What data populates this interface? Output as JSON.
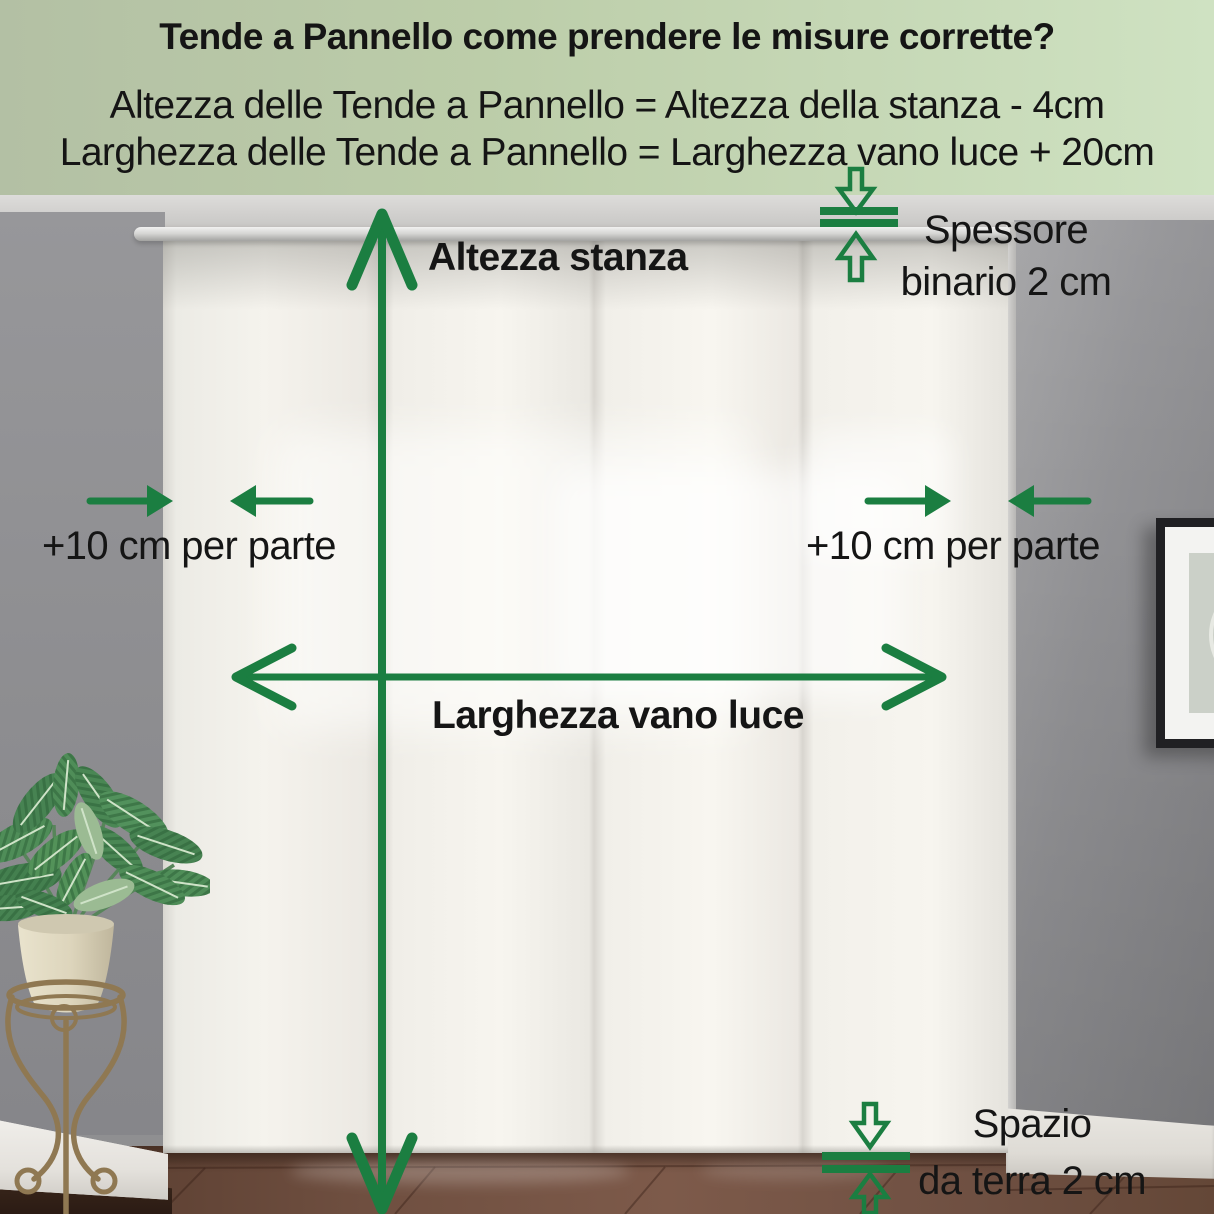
{
  "colors": {
    "accent_green": "#1b7e41",
    "header_bg_left": "#b3c0a4",
    "header_bg_right": "#cfe2c2",
    "text": "#151515"
  },
  "header": {
    "title": "Tende a Pannello come prendere le misure corrette?",
    "formula_height": "Altezza delle Tende a Pannello = Altezza della stanza - 4cm",
    "formula_width": "Larghezza delle Tende a Pannello = Larghezza vano luce + 20cm"
  },
  "labels": {
    "room_height": "Altezza stanza",
    "opening_width": "Larghezza vano luce",
    "extend_left": "+10 cm per parte",
    "extend_right": "+10 cm per parte",
    "track_thickness_line1": "Spessore",
    "track_thickness_line2": "binario 2 cm",
    "floor_gap_line1": "Spazio",
    "floor_gap_line2": "da terra 2 cm"
  },
  "icons": {
    "room_height_arrow": "vertical-double-arrow",
    "opening_width_arrow": "horizontal-double-arrow",
    "extend_arrows": "inward-pointing-arrow-pair",
    "track_thickness_indicator": "clamp-gap-arrows",
    "floor_gap_indicator": "clamp-gap-arrows"
  }
}
